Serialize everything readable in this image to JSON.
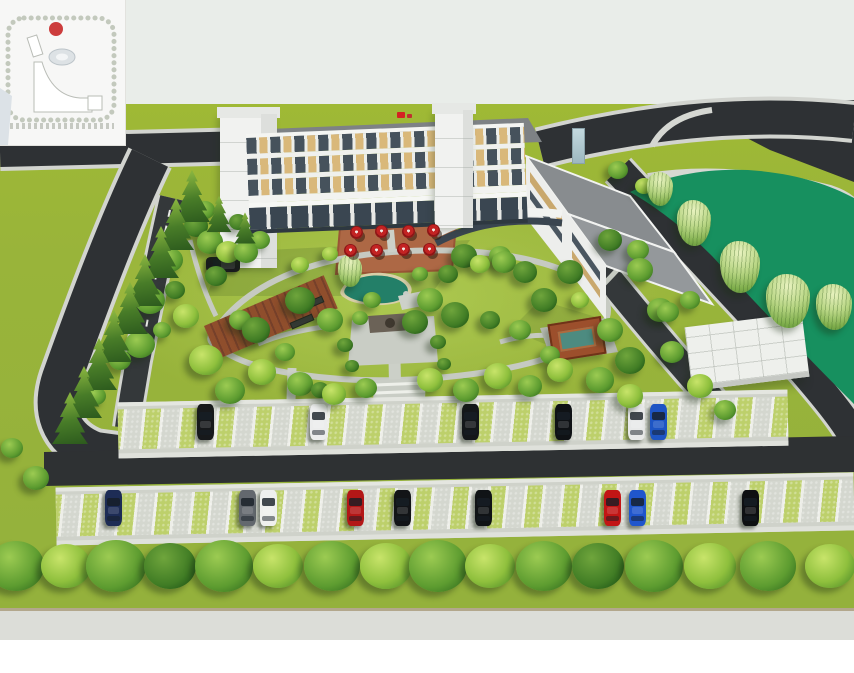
{
  "scene": {
    "sky_color": "#e9ede9",
    "grass_far": "#99b43a",
    "road_color": "#2e3134",
    "curb_color": "#d2d4cf",
    "path_color": "#c6cac2",
    "pond_color": "#17905f",
    "garden_pond_color": "#237f68",
    "bottom_road_color": "#dcddd8"
  },
  "inset_map": {
    "bg": "#f7f7f6",
    "marker_color": "#cc3c3c",
    "building_fill": "#ffffff",
    "pond_fill": "#dde2e5"
  },
  "building": {
    "wall_color": "#f1f2f0",
    "roof_color": "#7e8285",
    "window_tan": "#d9b87a",
    "window_dark": "#46525c",
    "upper_floors": 3,
    "flag_color": "#d42222"
  },
  "terrace": {
    "pad_color": "#ad6845",
    "umbrella_color": "#c32323",
    "umbrella_count": 8,
    "umbrellas": [
      [
        356,
        232
      ],
      [
        381,
        231
      ],
      [
        350,
        250
      ],
      [
        376,
        250
      ],
      [
        408,
        231
      ],
      [
        433,
        230
      ],
      [
        403,
        249
      ],
      [
        429,
        249
      ]
    ]
  },
  "parking": {
    "stall_green": "#bdd06b",
    "stall_paver": "#d4d7cf",
    "stall_line": "#edeee8",
    "aisle_color": "#2e3133",
    "rows": [
      {
        "name": "upper",
        "car_y": 404,
        "cars": [
          [
            205,
            "#17191b"
          ],
          [
            318,
            "#eceded"
          ],
          [
            470,
            "#14171a"
          ],
          [
            563,
            "#0f1215"
          ],
          [
            636,
            "#e8e9e9"
          ],
          [
            658,
            "#1e55c4"
          ]
        ]
      },
      {
        "name": "lower",
        "car_y": 490,
        "cars": [
          [
            113,
            "#1d2c55"
          ],
          [
            247,
            "#63686e"
          ],
          [
            268,
            "#eff0ee"
          ],
          [
            355,
            "#b31717"
          ],
          [
            402,
            "#121417"
          ],
          [
            483,
            "#101316"
          ],
          [
            612,
            "#c21515"
          ],
          [
            637,
            "#2056cc"
          ],
          [
            750,
            "#0e1012"
          ]
        ]
      }
    ],
    "parked_side_car": {
      "x": 206,
      "y": 257,
      "color": "#1a1c1e"
    }
  },
  "trees": {
    "garden": [
      [
        150,
        300,
        30,
        "m"
      ],
      [
        140,
        344,
        30,
        "m"
      ],
      [
        170,
        260,
        26,
        "m"
      ],
      [
        196,
        226,
        24,
        "d"
      ],
      [
        210,
        242,
        26,
        "m"
      ],
      [
        228,
        252,
        24,
        "b"
      ],
      [
        186,
        316,
        26,
        "b"
      ],
      [
        206,
        360,
        34,
        "b"
      ],
      [
        230,
        390,
        30,
        "m"
      ],
      [
        262,
        372,
        28,
        "b"
      ],
      [
        300,
        384,
        26,
        "m"
      ],
      [
        334,
        394,
        24,
        "b"
      ],
      [
        366,
        388,
        22,
        "m"
      ],
      [
        300,
        300,
        30,
        "d"
      ],
      [
        330,
        320,
        26,
        "m"
      ],
      [
        256,
        330,
        28,
        "d"
      ],
      [
        246,
        252,
        24,
        "m"
      ],
      [
        216,
        276,
        22,
        "d"
      ],
      [
        300,
        265,
        18,
        "b"
      ],
      [
        330,
        254,
        16,
        "b"
      ],
      [
        430,
        300,
        26,
        "m"
      ],
      [
        455,
        315,
        28,
        "d"
      ],
      [
        415,
        322,
        26,
        "d"
      ],
      [
        464,
        256,
        26,
        "d"
      ],
      [
        504,
        262,
        24,
        "m"
      ],
      [
        480,
        264,
        20,
        "b"
      ],
      [
        500,
        256,
        22,
        "m"
      ],
      [
        525,
        272,
        24,
        "d"
      ],
      [
        544,
        300,
        26,
        "d"
      ],
      [
        580,
        300,
        18,
        "b"
      ],
      [
        570,
        272,
        26,
        "d"
      ],
      [
        610,
        240,
        24,
        "d"
      ],
      [
        638,
        250,
        22,
        "m"
      ],
      [
        618,
        170,
        20,
        "m"
      ],
      [
        644,
        186,
        18,
        "b"
      ],
      [
        660,
        310,
        26,
        "m"
      ],
      [
        630,
        360,
        30,
        "d"
      ],
      [
        672,
        352,
        24,
        "m"
      ],
      [
        700,
        386,
        26,
        "b"
      ],
      [
        725,
        410,
        22,
        "m"
      ],
      [
        668,
        312,
        22,
        "m"
      ],
      [
        610,
        330,
        26,
        "m"
      ],
      [
        640,
        270,
        26,
        "m"
      ],
      [
        430,
        380,
        26,
        "b"
      ],
      [
        466,
        390,
        26,
        "m"
      ],
      [
        498,
        376,
        28,
        "b"
      ],
      [
        530,
        386,
        24,
        "m"
      ],
      [
        560,
        370,
        26,
        "b"
      ],
      [
        600,
        380,
        28,
        "m"
      ],
      [
        630,
        396,
        26,
        "b"
      ],
      [
        345,
        345,
        16,
        "d"
      ],
      [
        352,
        366,
        14,
        "d"
      ],
      [
        438,
        342,
        16,
        "d"
      ],
      [
        444,
        364,
        14,
        "d"
      ],
      [
        320,
        390,
        18,
        "d"
      ],
      [
        466,
        388,
        18,
        "d"
      ],
      [
        285,
        352,
        20,
        "m"
      ],
      [
        372,
        300,
        18,
        "m"
      ],
      [
        448,
        274,
        20,
        "d"
      ],
      [
        420,
        274,
        16,
        "m"
      ],
      [
        360,
        318,
        16,
        "m"
      ],
      [
        520,
        330,
        22,
        "m"
      ],
      [
        490,
        320,
        20,
        "d"
      ],
      [
        550,
        355,
        20,
        "m"
      ],
      [
        240,
        320,
        22,
        "m"
      ],
      [
        175,
        290,
        20,
        "d"
      ],
      [
        162,
        330,
        18,
        "m"
      ],
      [
        120,
        360,
        22,
        "m"
      ],
      [
        96,
        396,
        20,
        "m"
      ],
      [
        36,
        478,
        26,
        "m"
      ],
      [
        12,
        448,
        22,
        "m"
      ],
      [
        205,
        210,
        20,
        "m"
      ],
      [
        238,
        222,
        18,
        "d"
      ],
      [
        260,
        240,
        20,
        "m"
      ],
      [
        660,
        190,
        16,
        "m"
      ],
      [
        690,
        300,
        20,
        "m"
      ]
    ],
    "street_row_y": 566,
    "street_row": [
      [
        16,
        56,
        "m"
      ],
      [
        66,
        50,
        "b"
      ],
      [
        116,
        60,
        "m"
      ],
      [
        170,
        52,
        "d"
      ],
      [
        224,
        58,
        "m"
      ],
      [
        278,
        50,
        "b"
      ],
      [
        332,
        56,
        "m"
      ],
      [
        386,
        52,
        "b"
      ],
      [
        438,
        58,
        "m"
      ],
      [
        490,
        50,
        "b"
      ],
      [
        544,
        56,
        "m"
      ],
      [
        598,
        52,
        "d"
      ],
      [
        654,
        58,
        "m"
      ],
      [
        710,
        52,
        "b"
      ],
      [
        768,
        56,
        "m"
      ],
      [
        830,
        50,
        "b"
      ]
    ],
    "boundary_conifers": [
      [
        192,
        196,
        1
      ],
      [
        176,
        224,
        1
      ],
      [
        161,
        252,
        1
      ],
      [
        145,
        280,
        1
      ],
      [
        130,
        308,
        1
      ],
      [
        114,
        336,
        1
      ],
      [
        99,
        364,
        1
      ],
      [
        84,
        392,
        1
      ],
      [
        70,
        418,
        1
      ],
      [
        214,
        206,
        0.7
      ],
      [
        238,
        218,
        0.6
      ]
    ],
    "willows": [
      [
        694,
        218,
        34,
        46
      ],
      [
        660,
        186,
        26,
        34
      ],
      [
        740,
        262,
        40,
        52
      ],
      [
        788,
        296,
        44,
        54
      ],
      [
        834,
        302,
        36,
        46
      ],
      [
        350,
        268,
        24,
        32
      ]
    ]
  },
  "pergola": {
    "color": "#8f4e2c",
    "bench_count": 2
  },
  "pavilion": {
    "roof_color": "#9c4f2c",
    "inner_color": "#4d8b80"
  }
}
